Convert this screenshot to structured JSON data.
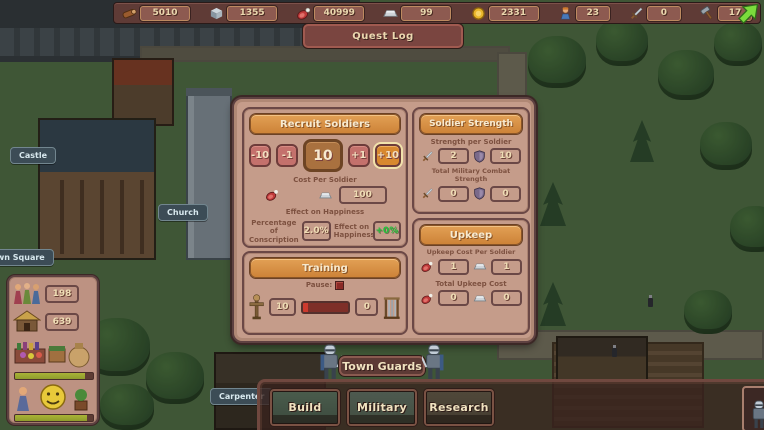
{
  "top_bar": {
    "resources": [
      {
        "name": "wood",
        "value": "5010"
      },
      {
        "name": "stone",
        "value": "1355"
      },
      {
        "name": "meat",
        "value": "40999"
      },
      {
        "name": "iron",
        "value": "99"
      },
      {
        "name": "gold",
        "value": "2331"
      },
      {
        "name": "population",
        "value": "23"
      },
      {
        "name": "swords",
        "value": "0"
      },
      {
        "name": "hammers",
        "value": "17"
      }
    ]
  },
  "quest_log": {
    "label": "Quest Log"
  },
  "map_labels": {
    "castle": "Castle",
    "church": "Church",
    "town_square": "Town Square",
    "carpenter": "Carpenter"
  },
  "left_panel": {
    "population": "198",
    "housing": "639",
    "market_progress": 90,
    "happiness_progress": 92
  },
  "recruit": {
    "title": "Recruit Soldiers",
    "minus10": "-10",
    "minus1": "-1",
    "amount": "10",
    "plus1": "+1",
    "plus10": "+10",
    "cost_label": "Cost Per Soldier",
    "cost_value": "100",
    "effect_heading": "Effect on Happiness",
    "conscription_label": "Percentage of Conscription",
    "conscription_value": "2.0%",
    "happiness_label": "Effect on Happiness",
    "happiness_value": "+0%"
  },
  "strength": {
    "title": "Soldier Strength",
    "per_label": "Strength per Soldier",
    "attack_per": "2",
    "defense_per": "10",
    "total_label": "Total Military Combat Strength",
    "attack_total": "0",
    "defense_total": "0"
  },
  "upkeep": {
    "title": "Upkeep",
    "per_label": "Upkeep Cost Per Soldier",
    "meat_per": "1",
    "iron_per": "1",
    "total_label": "Total Upkeep Cost",
    "meat_total": "0",
    "iron_total": "0"
  },
  "training": {
    "title": "Training",
    "pause_label": "Pause:",
    "in_training": "10",
    "trained": "0",
    "progress": 12
  },
  "bottom": {
    "title": "Town Guards",
    "build": "Build",
    "military": "Military",
    "research": "Research"
  },
  "colors": {
    "header_orange": "#d88f41",
    "panel_rose": "#c59c8a",
    "happiness_positive": "#23c23b",
    "cursor_green": "#7bdc3c"
  }
}
